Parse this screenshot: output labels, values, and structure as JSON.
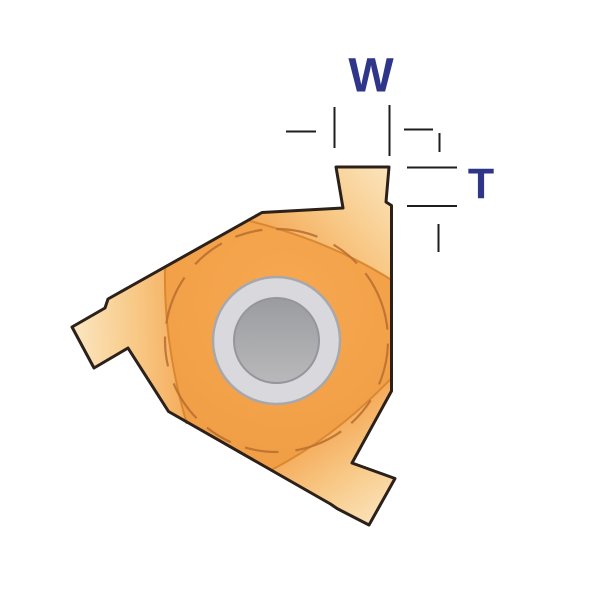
{
  "labels": {
    "width_label": "W",
    "thickness_label": "T"
  },
  "colors": {
    "dimension_label": "#2F3588",
    "dimension_line": "#1E1E1E",
    "insert_outline": "#2B211A",
    "insert_body": "#F4A34B",
    "insert_body_edge": "#EF9B42",
    "insert_facet_mid": "#F8CE93",
    "insert_facet_light": "#FBE7C3",
    "facet_divider": "#D8872F",
    "dashed_arc": "#BB7031",
    "hole_ring": "#D9D9DD",
    "hole_ring_border": "#A8A8AC",
    "hole_bore_dark": "#9B9CA0",
    "hole_bore_light": "#B9B9BB",
    "background": "#FFFFFF"
  }
}
